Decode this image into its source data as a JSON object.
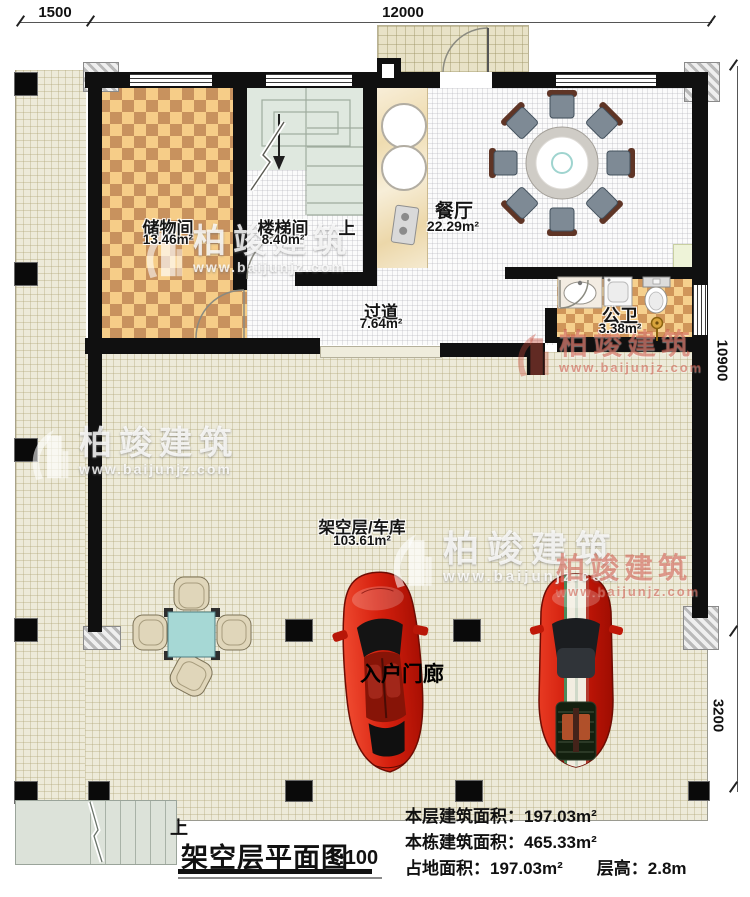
{
  "dimensions": {
    "top_left": "1500",
    "top_main": "12000",
    "right_upper": "10900",
    "right_lower": "3200"
  },
  "rooms": {
    "storage": {
      "name": "储物间",
      "area": "13.46m²"
    },
    "stairwell": {
      "name": "楼梯间",
      "area": "8.40m²",
      "up_label": "上"
    },
    "dining": {
      "name": "餐厅",
      "area": "22.29m²"
    },
    "hallway": {
      "name": "过道",
      "area": "7.64m²"
    },
    "bathroom": {
      "name": "公卫",
      "area": "3.38m²"
    },
    "garage": {
      "name": "架空层/车库",
      "area": "103.61m²"
    },
    "entry_porch": {
      "name": "入户门廊"
    }
  },
  "exterior": {
    "stairs_up_label": "上"
  },
  "watermark": {
    "brand": "柏竣建筑",
    "website": "www.baijunjz.com"
  },
  "title_block": {
    "title": "架空层平面图",
    "scale": "1:100",
    "stats": {
      "floor_area_label": "本层建筑面积：",
      "floor_area_value": "197.03m²",
      "building_area_label": "本栋建筑面积：",
      "building_area_value": "465.33m²",
      "land_area_label": "占地面积：",
      "land_area_value": "197.03m²",
      "floor_height_label": "层高：",
      "floor_height_value": "2.8m"
    }
  },
  "colors": {
    "car_red": "#cd1a0a",
    "checker_dark": "#c8925e",
    "checker_light": "#f6cd88",
    "table_teal": "#a6d8d5",
    "watermark_red": "#c84c3c",
    "wall_black": "#101010"
  }
}
